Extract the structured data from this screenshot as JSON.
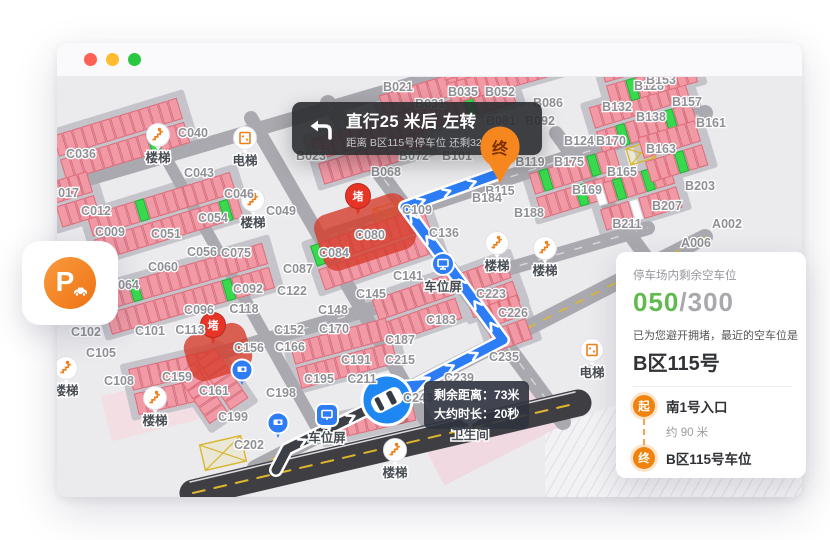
{
  "window": {
    "traffic_lights": [
      {
        "name": "close",
        "color": "#ff5f57"
      },
      {
        "name": "minimize",
        "color": "#febc2e"
      },
      {
        "name": "zoom",
        "color": "#28c840"
      }
    ]
  },
  "nav_banner": {
    "title": "直行25 米后 左转",
    "subtitle": "距离 B区115号停车位 还剩32 米",
    "icon": "turn-left-arrow"
  },
  "parking_card": {
    "letter": "P",
    "icon": "parking-car-icon"
  },
  "car_tooltip": {
    "line1_label": "剩余距离：",
    "line1_value": "73米",
    "line2_label": "大约时长：",
    "line2_value": "20秒"
  },
  "info_panel": {
    "remaining_label": "停车场内剩余空车位",
    "free_count": "050",
    "separator": "/",
    "total_count": "300",
    "avoid_text": "已为您避开拥堵，最近的空车位是",
    "spot_name": "B区115号",
    "route": {
      "start_badge": "起",
      "start_name": "南1号入口",
      "distance": "约 90 米",
      "end_badge": "终",
      "end_name": "B区115号车位"
    },
    "colors": {
      "free_green": "#62b94e",
      "badge_orange": "#f0830d"
    }
  },
  "map": {
    "colors": {
      "bg": "#ebebee",
      "pad": "#c4c4ca",
      "road": "#a9a9af",
      "dark_road": "#3e3e43",
      "stall": "#f19aa6",
      "stall_stroke": "#e06a79",
      "free_stall": "#39d94e",
      "route_blue": "#2b7cf5",
      "route_done": "#3c4046",
      "jam_red": "#e63527",
      "blob_red": "#d63c2c",
      "pin_orange": "#f6871f",
      "poi_orange": "#ef7f1a",
      "marker_blue": "#2f7df6"
    },
    "jam_label": "堵",
    "dest_pin": {
      "x": 500,
      "y": 150,
      "label": "终"
    },
    "route": {
      "traveled": [
        [
          276,
          470
        ],
        [
          287,
          449
        ],
        [
          387,
          400
        ]
      ],
      "ahead": [
        [
          387,
          400
        ],
        [
          503,
          340
        ],
        [
          405,
          207
        ],
        [
          497,
          174
        ]
      ],
      "car": {
        "x": 387,
        "y": 400,
        "angle": -27.3
      },
      "arrowhead": {
        "x": 416,
        "y": 385,
        "angle": -27.3
      }
    },
    "jams": [
      {
        "pin": [
          358,
          196
        ],
        "blob": [
          365,
          232,
          96,
          58,
          -18
        ]
      },
      {
        "pin": [
          213,
          325
        ],
        "blob": [
          218,
          352,
          64,
          48,
          -18
        ]
      }
    ],
    "hatches": [
      {
        "x": 390,
        "y": 214,
        "w": 30,
        "h": 19,
        "a": -17
      },
      {
        "x": 641,
        "y": 153,
        "w": 26,
        "h": 17,
        "a": -17
      },
      {
        "x": 223,
        "y": 453,
        "w": 42,
        "h": 26,
        "a": -13
      }
    ],
    "roads": [
      {
        "p": [
          [
            58,
            188
          ],
          [
            448,
            73
          ]
        ],
        "w": 14
      },
      {
        "p": [
          [
            330,
            236
          ],
          [
            705,
            113
          ]
        ],
        "w": 16,
        "dash": "white"
      },
      {
        "p": [
          [
            155,
            372
          ],
          [
            648,
            228
          ]
        ],
        "w": 14,
        "dash": "white"
      },
      {
        "p": [
          [
            255,
            468
          ],
          [
            705,
            237
          ]
        ],
        "w": 16,
        "dash": "yellow"
      },
      {
        "p": [
          [
            328,
            103
          ],
          [
            563,
            422
          ]
        ],
        "w": 16,
        "dash": "white"
      },
      {
        "p": [
          [
            251,
            118
          ],
          [
            430,
            428
          ]
        ],
        "w": 14
      },
      {
        "p": [
          [
            556,
            133
          ],
          [
            705,
            338
          ]
        ],
        "w": 14
      },
      {
        "p": [
          [
            166,
            158
          ],
          [
            315,
            425
          ]
        ],
        "w": 12
      },
      {
        "p": [
          [
            193,
            493
          ],
          [
            578,
            403
          ]
        ],
        "w": 27,
        "c": "#3e3e43"
      },
      {
        "p": [
          [
            193,
            493
          ],
          [
            578,
            403
          ]
        ],
        "w": 2,
        "c": "#e0b62c",
        "dasharray": "12 10"
      },
      {
        "p": [
          [
            190,
            482
          ],
          [
            575,
            392
          ]
        ],
        "w": 1.5,
        "c": "#dcdcdf"
      }
    ],
    "bands": [
      {
        "x": 60,
        "y": 158,
        "n": 13,
        "a": -17,
        "g2": [
          9
        ]
      },
      {
        "x": 94,
        "y": 238,
        "n": 15,
        "a": -17,
        "g1": [
          5
        ],
        "g2": [
          13
        ]
      },
      {
        "x": 106,
        "y": 312,
        "n": 17,
        "a": -16,
        "g1": [
          3
        ],
        "g2": [
          12
        ]
      },
      {
        "x": 134,
        "y": 392,
        "n": 9,
        "a": -13
      },
      {
        "x": 318,
        "y": 162,
        "n": 11,
        "a": -17
      },
      {
        "x": 386,
        "y": 118,
        "n": 13,
        "a": -17,
        "g2": [
          8
        ]
      },
      {
        "x": 446,
        "y": 82,
        "n": 12,
        "a": -16,
        "g1": [
          7
        ]
      },
      {
        "x": 536,
        "y": 196,
        "n": 9,
        "a": -17,
        "g1": [
          1,
          6
        ],
        "g2": [
          4
        ]
      },
      {
        "x": 596,
        "y": 130,
        "n": 10,
        "a": -17,
        "g2": [
          2,
          7
        ]
      },
      {
        "x": 600,
        "y": 208,
        "n": 8,
        "a": -17,
        "g1": [
          2,
          5
        ],
        "w1": [
          0
        ],
        "w2": [
          3
        ]
      },
      {
        "x": 318,
        "y": 268,
        "n": 12,
        "a": -19,
        "g1": [
          0
        ]
      },
      {
        "x": 380,
        "y": 322,
        "n": 8,
        "a": -19
      },
      {
        "x": 330,
        "y": 442,
        "n": 9,
        "a": -13,
        "single": true
      },
      {
        "x": 466,
        "y": 296,
        "n": 5,
        "a": -20
      },
      {
        "x": 196,
        "y": 362,
        "n": 6,
        "a": 56
      },
      {
        "x": 488,
        "y": 330,
        "n": 4,
        "a": -20
      },
      {
        "x": 606,
        "y": 84,
        "n": 9,
        "a": -16,
        "g2": [
          2
        ]
      },
      {
        "x": 645,
        "y": 160,
        "n": 6,
        "a": -17,
        "g2": [
          3
        ]
      },
      {
        "x": 56,
        "y": 205,
        "n": 4,
        "a": -17
      },
      {
        "x": 296,
        "y": 366,
        "n": 10,
        "a": -15
      }
    ],
    "pois": [
      {
        "type": "stairs",
        "x": 158,
        "y": 135,
        "label": "楼梯"
      },
      {
        "type": "stairs",
        "x": 253,
        "y": 200,
        "label": "楼梯"
      },
      {
        "type": "stairs",
        "x": 497,
        "y": 243,
        "label": "楼梯"
      },
      {
        "type": "stairs",
        "x": 545,
        "y": 248,
        "label": "楼梯"
      },
      {
        "type": "stairs",
        "x": 66,
        "y": 368,
        "label": "楼梯"
      },
      {
        "type": "stairs",
        "x": 155,
        "y": 398,
        "label": "楼梯"
      },
      {
        "type": "stairs",
        "x": 395,
        "y": 450,
        "label": "楼梯"
      },
      {
        "type": "elevator",
        "x": 245,
        "y": 138,
        "label": "电梯"
      },
      {
        "type": "elevator",
        "x": 592,
        "y": 350,
        "label": "电梯"
      },
      {
        "type": "toilet",
        "x": 470,
        "y": 412,
        "label": "卫生间"
      },
      {
        "type": "screen",
        "x": 443,
        "y": 264,
        "label": "车位屏"
      },
      {
        "type": "screen-square",
        "x": 327,
        "y": 415,
        "label": "车位屏"
      },
      {
        "type": "camera",
        "x": 242,
        "y": 370
      },
      {
        "type": "camera",
        "x": 278,
        "y": 423
      }
    ],
    "zone_labels": [
      [
        "B021",
        398,
        87
      ],
      [
        "B035",
        463,
        92
      ],
      [
        "B052",
        500,
        92
      ],
      [
        "B031",
        430,
        104
      ],
      [
        "B086",
        548,
        103
      ],
      [
        "B128",
        649,
        86
      ],
      [
        "B153",
        661,
        80
      ],
      [
        "B157",
        687,
        102
      ],
      [
        "B132",
        617,
        107
      ],
      [
        "B138",
        651,
        117
      ],
      [
        "B161",
        711,
        123
      ],
      [
        "B163",
        661,
        149
      ],
      [
        "B170",
        611,
        141
      ],
      [
        "B124",
        579,
        141
      ],
      [
        "B119",
        530,
        162
      ],
      [
        "B175",
        569,
        162
      ],
      [
        "B165",
        622,
        172
      ],
      [
        "B203",
        700,
        186
      ],
      [
        "B169",
        587,
        190
      ],
      [
        "B207",
        667,
        206
      ],
      [
        "B211",
        627,
        224
      ],
      [
        "A002",
        727,
        224
      ],
      [
        "A006",
        696,
        243
      ],
      [
        "B081",
        501,
        121
      ],
      [
        "B092",
        540,
        121
      ],
      [
        "B023",
        311,
        156
      ],
      [
        "B072",
        414,
        156
      ],
      [
        "B101",
        457,
        156
      ],
      [
        "B068",
        386,
        172
      ],
      [
        "B115",
        500,
        191
      ],
      [
        "B184",
        487,
        198
      ],
      [
        "B188",
        529,
        213
      ],
      [
        "C036",
        81,
        154
      ],
      [
        "C040",
        193,
        133
      ],
      [
        "C043",
        199,
        173
      ],
      [
        "C017",
        64,
        193
      ],
      [
        "C046",
        239,
        194
      ],
      [
        "C012",
        96,
        211
      ],
      [
        "C049",
        281,
        211
      ],
      [
        "C054",
        213,
        218
      ],
      [
        "C009",
        110,
        232
      ],
      [
        "C051",
        166,
        234
      ],
      [
        "C056",
        202,
        252
      ],
      [
        "C075",
        236,
        253
      ],
      [
        "C060",
        163,
        267
      ],
      [
        "C064",
        124,
        285
      ],
      [
        "C087",
        298,
        269
      ],
      [
        "C084",
        334,
        253
      ],
      [
        "C080",
        370,
        235
      ],
      [
        "C092",
        248,
        289
      ],
      [
        "C122",
        292,
        291
      ],
      [
        "C096",
        199,
        310
      ],
      [
        "C118",
        244,
        309
      ],
      [
        "C148",
        333,
        310
      ],
      [
        "C101",
        150,
        331
      ],
      [
        "C113",
        190,
        330
      ],
      [
        "C152",
        289,
        330
      ],
      [
        "C170",
        334,
        329
      ],
      [
        "C156",
        249,
        348
      ],
      [
        "C166",
        290,
        347
      ],
      [
        "C102",
        86,
        332
      ],
      [
        "C105",
        101,
        353
      ],
      [
        "C108",
        119,
        381
      ],
      [
        "C159",
        177,
        377
      ],
      [
        "C161",
        214,
        391
      ],
      [
        "C199",
        233,
        417
      ],
      [
        "C202",
        249,
        445
      ],
      [
        "C109",
        417,
        210
      ],
      [
        "C136",
        444,
        233
      ],
      [
        "C141",
        408,
        276
      ],
      [
        "C145",
        371,
        294
      ],
      [
        "C183",
        441,
        320
      ],
      [
        "C187",
        400,
        340
      ],
      [
        "C191",
        356,
        360
      ],
      [
        "C215",
        400,
        360
      ],
      [
        "C195",
        319,
        379
      ],
      [
        "C211",
        362,
        379
      ],
      [
        "C198",
        281,
        393
      ],
      [
        "C223",
        491,
        294
      ],
      [
        "C226",
        513,
        313
      ],
      [
        "C235",
        504,
        357
      ],
      [
        "C239",
        459,
        378
      ],
      [
        "C243",
        418,
        398
      ]
    ]
  }
}
